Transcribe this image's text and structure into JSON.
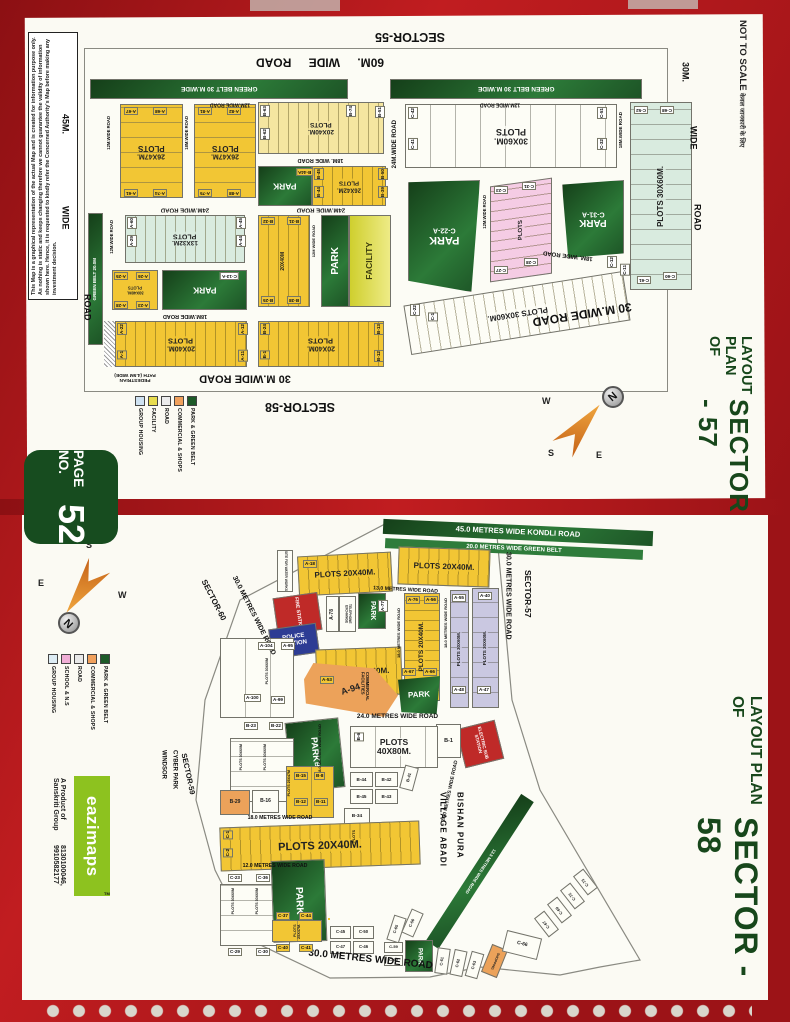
{
  "page": {
    "not_to_scale": "NOT TO SCALE",
    "not_to_scale_sub": "केवल जानकारी के लिए",
    "disclaimer": "This Map is a graphical representation of the actual Map and is created for information purpose only. As nothing is static and keeps changing therefore we cannot guarantee the validity of information shown here. Hence, it is requested to kindly refer the Concerned Authority's Map before making any investment decision.",
    "badge": {
      "label": "PAGE NO.",
      "number": "52"
    },
    "brand": {
      "name": "eazimaps",
      "tm": "TM",
      "byline1": "A Product of Sanskriti Group",
      "byline2": "8130100046, 9910582177"
    },
    "frame_color": "#a8181d",
    "accent_green": "#17471b"
  },
  "compass": {
    "n": "N",
    "s": "S",
    "e": "E",
    "w": "W"
  },
  "legend57": {
    "items": [
      {
        "label": "GROUP HOUSING",
        "color": "#cfe2f2"
      },
      {
        "label": "FACILITY",
        "color": "#e8dc4e"
      },
      {
        "label": "ROAD",
        "color": "#ececec"
      },
      {
        "label": "COMMERCIAL & SHOPS",
        "color": "#f0a05c"
      },
      {
        "label": "PARK & GREEN BELT",
        "color": "#1d5a28"
      }
    ]
  },
  "legend58": {
    "items": [
      {
        "label": "GROUP HOUSING",
        "color": "#ddecf4"
      },
      {
        "label": "SCHOOL & N.S",
        "color": "#f0aed6"
      },
      {
        "label": "ROAD",
        "color": "#e8e8e8"
      },
      {
        "label": "COMMERCIAL & SHOPS",
        "color": "#f0a05c"
      },
      {
        "label": "PARK & GREEN BELT",
        "color": "#1d5a28"
      }
    ]
  },
  "s57": {
    "title1": "LAYOUT PLAN OF",
    "title2": "SECTOR - 57",
    "sec": {
      "s55": "SECTOR-55",
      "s58": "SECTOR-58"
    },
    "roads": {
      "r60": "60M.  WIDE  ROAD",
      "gb30": "GREEN BELT 30 M.WIDE",
      "gb20": "GREEN BELT 20.0M",
      "r12": "12M.WIDE ROAD",
      "r12w": "12M WIDE ROAD",
      "r18": "18M.WIDE ROAD",
      "r18s": "18M. WIDE ROAD",
      "r24": "24M.WIDE ROAD",
      "r30": "30 M.WIDE ROAD",
      "m45": "45M.",
      "m30": "30M.",
      "wide": "WIDE",
      "road": "ROAD",
      "ped1": "PEDESTRIAN",
      "ped2": "PATH (4.5M WIDE)"
    },
    "b": {
      "plots": "PLOTS",
      "park": "PARK",
      "facility": "FACILITY",
      "s2647": "26X47M.",
      "s2040": "20X40M.",
      "s2040b": "20X40M",
      "s2642": "26X42M.",
      "s1332": "13X32M.",
      "s3040": "30X40M.",
      "s3060": "30X60M.",
      "p3060": "PLOTS 30X60M."
    },
    "t": {
      "a67": "A-67",
      "a68": "A-68",
      "a61": "A-61",
      "a74": "A-74",
      "a81": "A-81",
      "a82": "A-82",
      "a75": "A-75",
      "a88": "A-88",
      "b63": "B-63",
      "b62": "B-62",
      "b74": "B-74",
      "b51": "B-51",
      "b44a": "B-44A",
      "b45": "B-45",
      "b44": "B-44",
      "b50": "B-50",
      "b39": "B-39",
      "a60": "A-60",
      "a29": "A-29",
      "a45": "A-45",
      "a44": "A-44",
      "b32": "B-32",
      "b31": "B-31",
      "b25": "B-25",
      "b38": "B-38",
      "a25": "A-25",
      "a26": "A-26",
      "a28": "A-28",
      "a23": "A-23",
      "c13a": "C-13-A",
      "a22": "A-22",
      "a1": "A-1",
      "a12": "A-12",
      "a11": "A-11",
      "b24": "B-24",
      "b1": "B-1",
      "b13": "B-13",
      "b12": "B-12",
      "c42": "C-42",
      "c41": "C-41",
      "c51": "C-51",
      "c32": "C-32",
      "c22a": "C-22-A",
      "c23": "C-23",
      "c31": "C-31",
      "c28": "C-28",
      "c27": "C-27",
      "c31a": "C-31-A",
      "c52": "C-52",
      "c68": "C-68",
      "c61": "C-61",
      "c60": "C-60",
      "c22": "C-22",
      "c1": "C-1",
      "c12": "C-12",
      "c11": "C-11"
    }
  },
  "s58": {
    "title1": "LAYOUT PLAN OF",
    "title2": "SECTOR - 58",
    "sec": {
      "s60": "SECTOR-60",
      "s57": "SECTOR-57",
      "s59": "SECTOR-59"
    },
    "roads": {
      "kondli": "45.0 METRES WIDE KONDLI ROAD",
      "gbelt": "20.0 METRES WIDE GREEN BELT",
      "r30": "30.0 METRES WIDE ROAD",
      "r24": "24.0 METRES WIDE ROAD",
      "r18": "18.0 METRES WIDE ROAD",
      "r13": "13.0 METRES WIDE ROAD",
      "r12": "12.0 METRES WIDE ROAD",
      "r135": "13.5 METRES WIDE ROAD"
    },
    "b": {
      "p2040": "PLOTS 20X40M.",
      "p3060": "PLOTS 30X60M.",
      "p3060s": "PLOTS 30X60M",
      "p2547": "PLOTS 25X47M.",
      "p2547s": "PLOTS 25X47M",
      "plots": "PLOTS",
      "s4080": "40X80M.",
      "park": "PARK",
      "fire": "FIRE STATION",
      "police": "POLICE STATION",
      "tel": "TELEPHONE EXCHANGE",
      "elec": "ELECTRIC SUB STATION",
      "comm": "COMMERCIAL FACILITIES",
      "shopping": "SHOPPING",
      "water": "SITE FOR WATER WORKS",
      "village1": "VILLAGE ABADI",
      "village2": "BISHAN PURA",
      "windsor1": "WINDSOR",
      "windsor2": "CYBER PARK"
    },
    "t": {
      "a18": "A-18",
      "a53": "A-53",
      "a76": "A-76",
      "a56": "A-56",
      "a55": "A-55",
      "a40": "A-40",
      "a104": "A-104",
      "a95": "A-95",
      "a100": "A-100",
      "a99": "A-99",
      "a94": "A-94",
      "a78": "A-78",
      "a77": "A-77",
      "a67": "A-67",
      "a66": "A-66",
      "a48": "A-48",
      "a47": "A-47",
      "b6": "B-6",
      "b1": "B-1",
      "b7": "B-7",
      "b23": "B-23",
      "b22": "B-22",
      "b29": "B-29",
      "b16": "B-16",
      "b15": "B-15",
      "b8": "B-8",
      "b12": "B-12",
      "b11": "B-11",
      "b44": "B-44",
      "b42": "B-42",
      "b45": "B-45",
      "b43": "B-43",
      "b41": "B-41",
      "b34": "B-34",
      "c1": "C-1",
      "c2": "C-2",
      "c23": "C-23",
      "c36": "C-36",
      "c29": "C-29",
      "c30": "C-30",
      "c37": "C-37",
      "c44": "C-44",
      "c40": "C-40",
      "c41": "C-41",
      "c45": "C-45",
      "c50": "C-50",
      "c47": "C-47",
      "c46": "C-46",
      "c65": "C-65",
      "c56": "C-56",
      "c59": "C-59",
      "c60": "C-60",
      "c61": "C-61",
      "c62": "C-62",
      "c63": "C-63",
      "c66": "C-66",
      "c67": "C-67",
      "c69": "C-69",
      "c72": "C-72",
      "c73": "C-73"
    }
  }
}
